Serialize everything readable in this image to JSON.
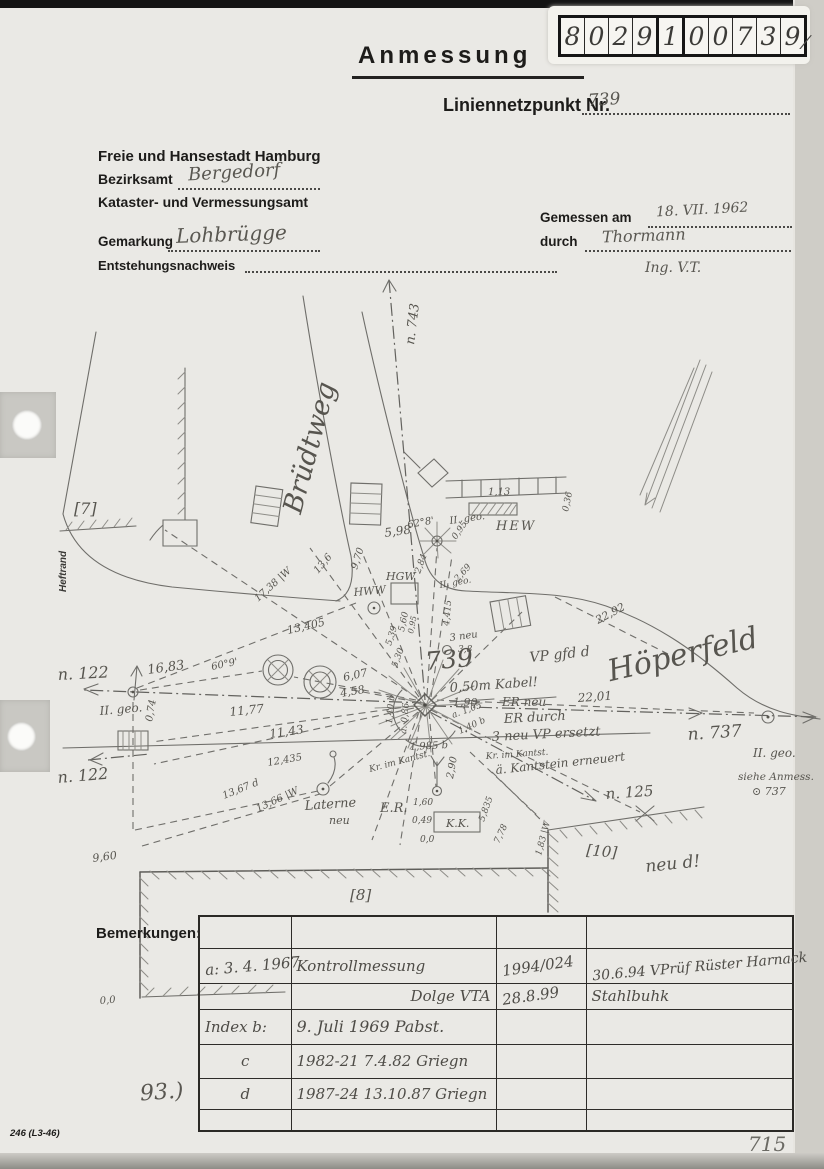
{
  "colors": {
    "paper": "#eae9e5",
    "pencil": "#6f6e6a",
    "print_ink": "#1d1c1a",
    "handwriting": "#595751"
  },
  "sticker": {
    "digits": [
      "8",
      "0",
      "2",
      "9",
      "1",
      "0",
      "0",
      "7",
      "3",
      "9"
    ],
    "mark": "∕"
  },
  "header": {
    "title": "Anmessung",
    "point_label": "Liniennetzpunkt Nr.",
    "point_number": "739",
    "city": "Freie und Hansestadt Hamburg",
    "bezirksamt_label": "Bezirksamt",
    "bezirksamt_value": "Bergedorf",
    "amt": "Kataster- und Vermessungsamt",
    "gemarkung_label": "Gemarkung",
    "gemarkung_value": "Lohbrügge",
    "entstehung_label": "Entstehungsnachweis",
    "gemessen_label": "Gemessen am",
    "gemessen_value": "18. VII. 1962",
    "durch_label": "durch",
    "durch_value": "Thormann",
    "ing": "Ing. V.T."
  },
  "sketch": {
    "street_bruedtweg": "Brüdtweg",
    "street_hoeperfeld": "Höperfeld",
    "line_n743": "n. 743",
    "pt_n122": "n. 122",
    "pt_n122_dist": "16,83",
    "pt_n122_b": "n. 122",
    "pt_n737": "n. 737",
    "pt_n125": "n. 125",
    "geo": "II. geo.",
    "siehe_anmess": "siehe Anmess.",
    "siehe_737": "⊙ 737",
    "hew": "HEW",
    "hgw": "HGW",
    "hww": "HWW",
    "pt739": "739",
    "kabel": "0,50m Kabel!",
    "struck_dist": "1,90",
    "struck_er_neu": "ER neu",
    "er_durch": "ER durch",
    "vp_ersetzt": "3 neu VP ersetzt",
    "kantstein_erneuert": "ä. Kantstein erneuert",
    "kr_im_kantst": "Kr. im Kantst.",
    "vp_gfd": "VP gfd d",
    "laterne": "Laterne",
    "laterne_neu": "neu",
    "er": "E.R.",
    "kk": "K.K.",
    "neu_d": "neu d!",
    "heftrand": "Heftrand",
    "haus7": "[7]",
    "haus8": "[8]",
    "haus10": "[10]",
    "m_598": "5,98",
    "m_6208": "62°8'",
    "m_095": "0,95",
    "m_113": "1,13",
    "m_036": "0,36",
    "m_970": "9,70",
    "m_136": "13,6",
    "m_1738": "17,38 |W",
    "m_13405": "13,405",
    "m_609": "60°9'",
    "m_1177": "11,77",
    "m_1143": "11,43",
    "m_12435": "12,435",
    "m_1367": "13,67 d",
    "m_1366": "13,66 |W",
    "m_607": "6,07",
    "m_458": "4,58",
    "m_284": "2,84",
    "m_269": "2,69",
    "m_4415": "4,415",
    "m_560": "5,60",
    "m_539": "5,39",
    "m_530": "5,30",
    "m_3neu": "3 neu",
    "m_38": "3,8",
    "m_2201": "22,01",
    "m_2292": "22,92",
    "m_140": "1,40 b",
    "m_a105": "a. 1,05",
    "m_1985": "1,985 b",
    "m_a086": "a. 0,86",
    "m_290": "2,90",
    "m_160": "1,60",
    "m_049": "0,49",
    "m_00": "0,0",
    "m_5835": "5,835",
    "m_778": "7,78",
    "m_183": "1,83 |W",
    "m_960": "9,60",
    "m_074": "0,74"
  },
  "remarks": {
    "label": "Bemerkungen:",
    "rows": [
      [
        "",
        "",
        "",
        ""
      ],
      [
        "a: 3. 4. 1967",
        "Kontrollmessung",
        "1994/024",
        "30.6.94 VPrüf Rüster Harnack"
      ],
      [
        "",
        "Dolge VTA",
        "28.8.99",
        "Stahlbuhk"
      ],
      [
        "Index b:",
        "9. Juli 1969   Pabst.",
        "",
        ""
      ],
      [
        "c",
        "1982-21   7.4.82   Griegn",
        "",
        ""
      ],
      [
        "d",
        "1987-24   13.10.87   Griegn",
        "",
        ""
      ],
      [
        "",
        "",
        "",
        ""
      ]
    ]
  },
  "footer": {
    "form_number": "246 (L3-46)",
    "page_number": "715",
    "margin_note": "93.)"
  }
}
